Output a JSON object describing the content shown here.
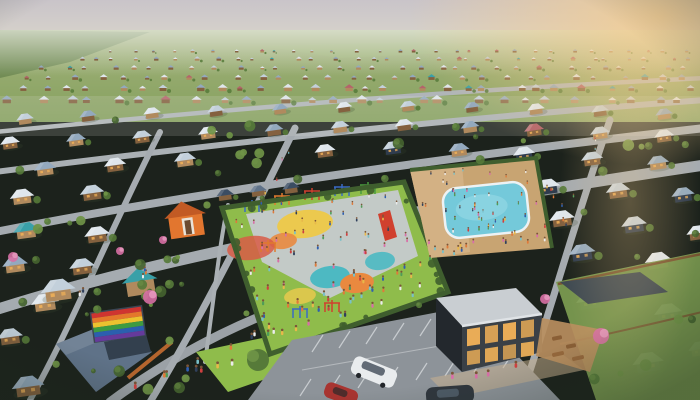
{
  "scene": {
    "setting": "aerial-view-suburban-neighborhood-at-sunset",
    "time_of_day": "sunset",
    "landmarks": {
      "central_playground": "large fenced playground full of children with colorful play circles, climbing frames and a red slide",
      "community_pool": "crowded community pool with swimmers northeast of the playground",
      "rainbow_roof": "rainbow pride mural painted on a house roof at lower left",
      "community_building": "modern dark two-story building with warm lit windows beside a parking lot",
      "parking_lot": "small parking lot with a white minivan, a red car and a dark car",
      "housing_grid": "dense diagonal grid of single-story houses with pale hip roofs",
      "horizon": "flat green fields fading into pale hazy sky with warm glow at upper right"
    },
    "estimates": {
      "houses_visible": 120,
      "people_visible": 200,
      "vehicles_visible": 3
    },
    "palette": {
      "sky_top": "#c9c4c9",
      "sky_horizon": "#dcd8cb",
      "sun_glow": "#f6cd8e",
      "field_far": "#a3b37c",
      "field_mid": "#85a05e",
      "field_shadow": "#5d7a44",
      "haze": "#e6e9de",
      "road": "#a5abb0",
      "road_dark": "#8d9399",
      "roof_white": "#dfe6ec",
      "roof_light": "#c3d0db",
      "roof_slate": "#93a9be",
      "roof_dark": "#5f7288",
      "roof_navy": "#3b4d63",
      "roof_red": "#b4636b",
      "roof_teal": "#39a0a8",
      "wall_tan": "#b08a5e",
      "wall_brown": "#84613f",
      "wall_navy": "#2f3c4e",
      "wall_orange": "#e2762f",
      "window_warm": "#f2b258",
      "tree_dark": "#44632f",
      "tree_mid": "#567a39",
      "tree_light": "#6f9447",
      "grass": "#7fae46",
      "grass_bright": "#8fbc4b",
      "hedge": "#3f5e2e",
      "park_surface": "#c6cacd",
      "circle_yellow": "#ecc94e",
      "circle_orange": "#e9893f",
      "circle_red": "#d85c47",
      "circle_teal": "#4db9c2",
      "pool_water": "#74c9da",
      "pool_deck": "#c8a472",
      "sand": "#d4b386",
      "flower_pink": "#d76fa4",
      "van_white": "#e9ecee",
      "car_red": "#a83430",
      "car_dark": "#30373e",
      "building_dark": "#3a4046",
      "building_roof": "#c9ced2",
      "deck_wood": "#b98e5e",
      "fence": "#7a4b2e",
      "equip_blue": "#3a6bc4",
      "equip_orange": "#e07a2e",
      "equip_red": "#d0402e",
      "equip_green": "#4a9c3f"
    },
    "rainbow_colors": [
      "#cf3430",
      "#e4772b",
      "#ecc22f",
      "#3e9b40",
      "#2b5fae",
      "#653a9b"
    ],
    "people_colors": [
      "#cf4040",
      "#2f5fb0",
      "#e8b84a",
      "#4f9c58",
      "#d86fa8",
      "#ececec",
      "#30405c",
      "#e07a3a",
      "#7ac0c8"
    ],
    "skin_tone": "#7a5538"
  }
}
